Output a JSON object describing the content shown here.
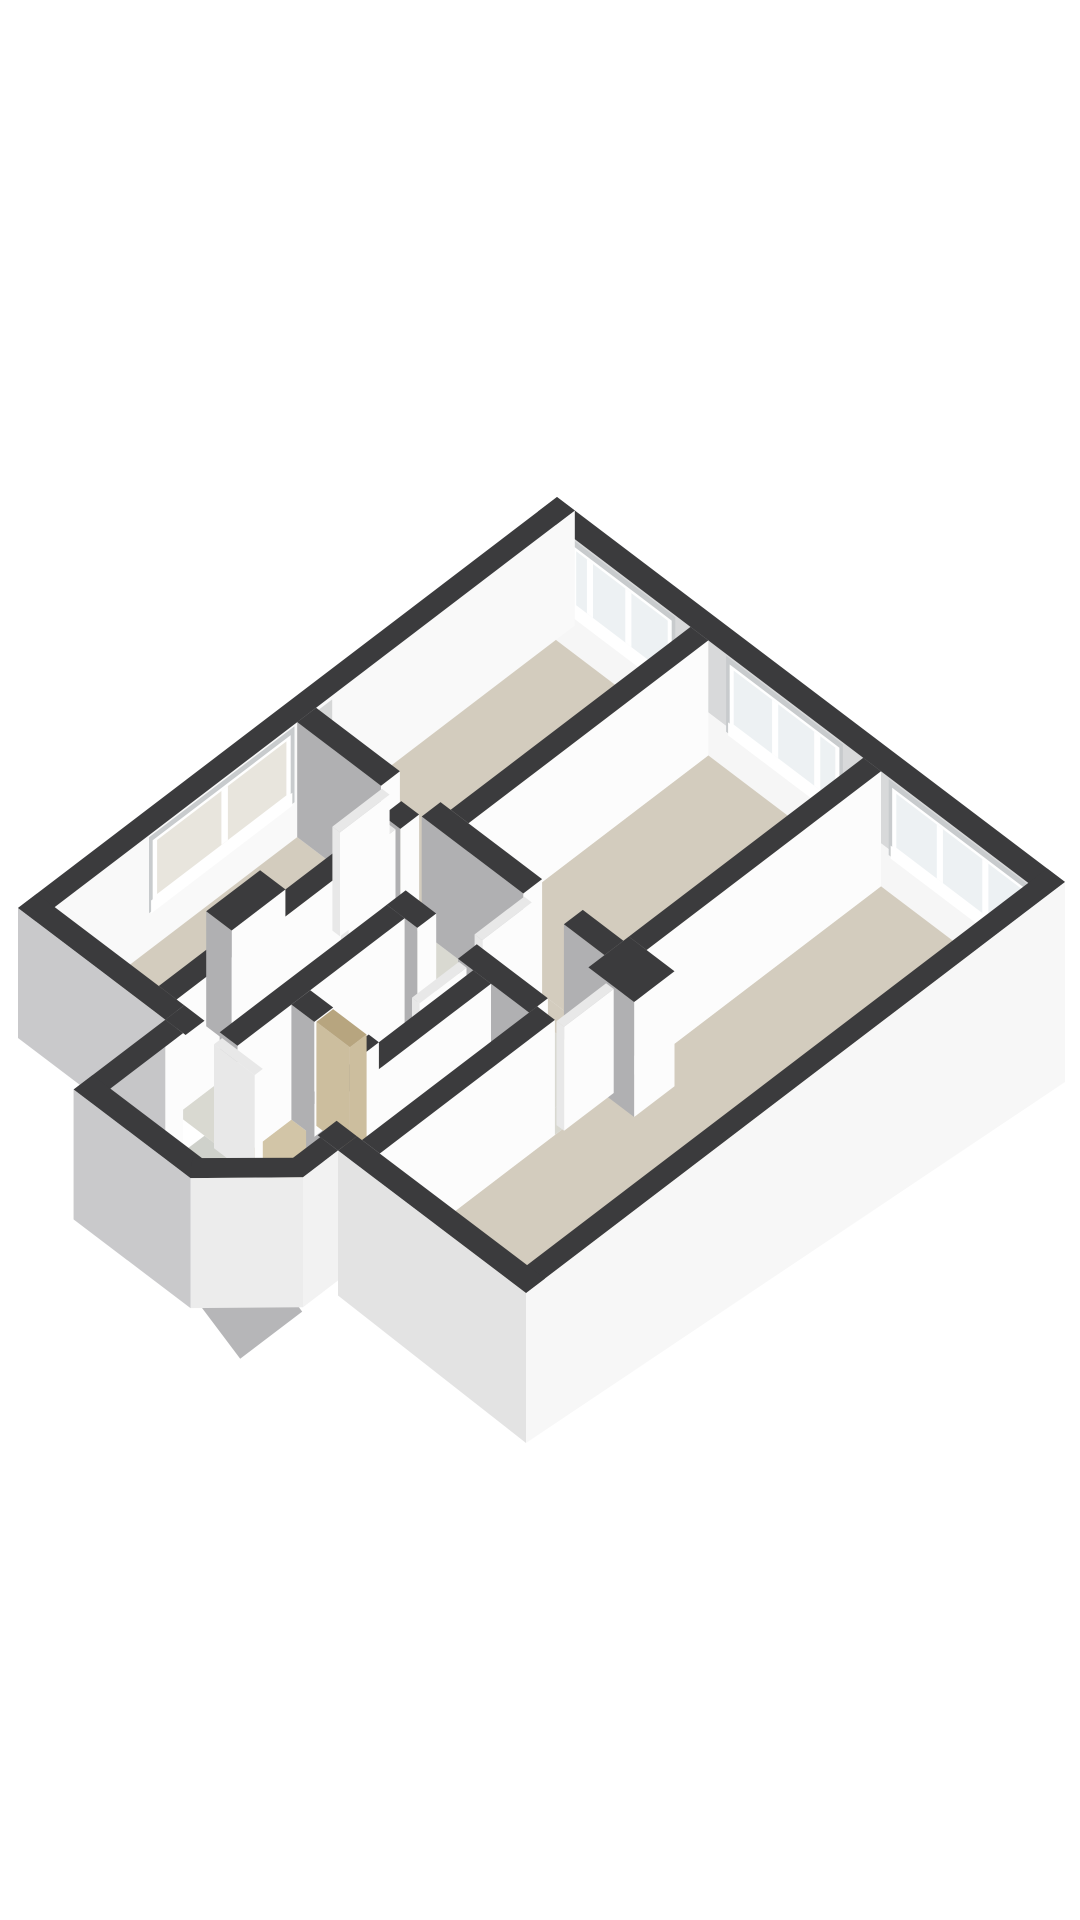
{
  "meta": {
    "description": "3D isometric floor plan render of an apartment, dark cut wall tops, white and grey wall faces, beige room floors, viewed from the south on a white background",
    "background": "#ffffff",
    "canvas": {
      "width": 1080,
      "height": 1920
    }
  },
  "projection": {
    "origin": [
      557,
      497
    ],
    "ux": [
      5.08,
      3.85
    ],
    "vy": [
      -5.39,
      4.11
    ],
    "wall_height": 115,
    "door_height": 104
  },
  "palette": {
    "wallTop": "#3b3b3d",
    "white": "#fcfcfc",
    "gray": "#b0b0b2",
    "grayLight": "#c6c6c8",
    "neUpper": "#d8d9da",
    "neLower": "#f6f6f6",
    "nwInner": "#f9f9f9",
    "recess": "#c8cbcd",
    "frame": "#ffffff",
    "glass": "#edf1f3",
    "frost": "#e8e5dd",
    "floorRoom": "#d3ccbe",
    "floorHall": "#d9d9d1",
    "floorBath": "#e0e2df",
    "floorWood": "#d2c5a7",
    "floorExt": "#cfd1cb",
    "stair": "#b6b6b8",
    "skirtSE": "#f7f7f7",
    "skirtSW": "#c9c9cb",
    "skirtSWLight": "#e3e3e3",
    "doorTop": "#e8e8e8",
    "doorWood": "#ccbe9e",
    "doorWoodTop": "#b7a57f",
    "nicheFill": "#d6d7d7",
    "diagFace": "#ececec",
    "extEFace": "#f2f2f2"
  },
  "elements": [
    {
      "t": "face",
      "n": "ne-wall-inner-upper",
      "plane": "y",
      "c": 3.5,
      "a": [
        0,
        100
      ],
      "top": [
        0,
        0
      ],
      "bot": [
        72,
        72
      ],
      "f": "neUpper"
    },
    {
      "t": "face",
      "n": "ne-wall-inner-lower",
      "plane": "y",
      "c": 3.5,
      "a": [
        0,
        100
      ],
      "top": [
        72,
        72
      ],
      "bot": [
        115,
        115
      ],
      "f": "neLower"
    },
    {
      "t": "window",
      "n": "window-bedroom-top",
      "plane": "y",
      "c": 3.5,
      "span": [
        6,
        27
      ],
      "mull": [
        0.2,
        0.56
      ],
      "f": "glass"
    },
    {
      "t": "window",
      "n": "window-bedroom-middle",
      "plane": "y",
      "c": 3.5,
      "span": [
        37,
        60
      ],
      "mull": [
        0.42,
        0.78
      ],
      "f": "glass"
    },
    {
      "t": "window",
      "n": "window-living-room",
      "plane": "y",
      "c": 3.5,
      "span": [
        69,
        97
      ],
      "mull": [
        0.36,
        0.68
      ],
      "f": "glass"
    },
    {
      "t": "top",
      "n": "ne-exterior-wall-top",
      "r": [
        0,
        0,
        100,
        3.5
      ]
    },
    {
      "t": "face",
      "n": "nw-wall-inner",
      "plane": "x",
      "c": 3.5,
      "a": [
        0,
        100
      ],
      "top": [
        0,
        0
      ],
      "bot": [
        115,
        115
      ],
      "f": "nwInner"
    },
    {
      "t": "face",
      "n": "nw-wall-niche",
      "plane": "x",
      "c": 3.5,
      "a": [
        45,
        50
      ],
      "top": [
        4,
        4
      ],
      "bot": [
        100,
        100
      ],
      "f": "nicheFill"
    },
    {
      "t": "window",
      "n": "window-left-room",
      "plane": "x",
      "c": 3.5,
      "span": [
        52,
        79
      ],
      "mull": [
        0.48
      ],
      "f": "frost"
    },
    {
      "t": "top",
      "n": "nw-exterior-wall-top",
      "r": [
        0,
        0,
        3.5,
        100
      ]
    },
    {
      "t": "floor",
      "n": "floor-bedroom-top",
      "r": [
        3.5,
        3.5,
        30,
        48
      ],
      "f": "floorRoom"
    },
    {
      "t": "floor",
      "n": "floor-bedroom-middle",
      "r": [
        33.5,
        3.5,
        64,
        48
      ],
      "f": "floorRoom"
    },
    {
      "t": "floor",
      "n": "floor-living-room",
      "r": [
        67.5,
        3.5,
        96.5,
        96.5
      ],
      "f": "floorRoom"
    },
    {
      "t": "floor",
      "n": "floor-left-bedroom",
      "r": [
        3.5,
        51.5,
        24,
        96.5
      ],
      "f": "floorRoom"
    },
    {
      "t": "floor",
      "n": "floor-hallway",
      "pts": [
        [
          27.5,
          51.5
        ],
        [
          64,
          51.5
        ],
        [
          64,
          62
        ],
        [
          36,
          62
        ],
        [
          36,
          96.5
        ],
        [
          27.5,
          96.5
        ]
      ],
      "f": "floorHall"
    },
    {
      "t": "floor",
      "n": "floor-bathroom",
      "r": [
        39.5,
        65.5,
        53,
        83
      ],
      "f": "floorBath"
    },
    {
      "t": "floor",
      "n": "floor-closet",
      "r": [
        39.5,
        86.5,
        53,
        96.5
      ],
      "f": "floorWood"
    },
    {
      "t": "floor",
      "n": "floor-toilet",
      "r": [
        56.5,
        65.5,
        64,
        96.5
      ],
      "f": "floorBath"
    },
    {
      "t": "floor",
      "n": "floor-stairwell",
      "r": [
        32.5,
        100,
        59.5,
        113.5
      ],
      "f": "floorExt"
    },
    {
      "t": "floor",
      "n": "threshold-bedroom-top",
      "r": [
        20,
        48,
        28,
        51.5
      ],
      "f": "floorRoom"
    },
    {
      "t": "floor",
      "n": "threshold-bedroom-middle",
      "r": [
        48,
        48,
        56,
        51.5
      ],
      "f": "floorRoom"
    },
    {
      "t": "floor",
      "n": "threshold-left-bedroom",
      "r": [
        24,
        55,
        27.5,
        64
      ],
      "f": "floorRoom"
    },
    {
      "t": "floor",
      "n": "threshold-living-room",
      "r": [
        64,
        54.5,
        67.5,
        64
      ],
      "f": "floorHall"
    },
    {
      "t": "floor",
      "n": "threshold-bathroom",
      "r": [
        42,
        62,
        50,
        65.5
      ],
      "f": "floorBath"
    },
    {
      "t": "floor",
      "n": "threshold-entry",
      "r": [
        33,
        96.5,
        59,
        100
      ],
      "f": "floorExt"
    },
    {
      "t": "wall",
      "n": "wall-bedrooms-divider",
      "r": [
        30,
        3.5,
        33.5,
        48
      ]
    },
    {
      "t": "wall",
      "n": "wall-hall-north-west",
      "r": [
        3.5,
        48,
        20,
        51.5
      ]
    },
    {
      "t": "wall",
      "n": "wall-hall-north-mid",
      "r": [
        28,
        48,
        48,
        51.5
      ]
    },
    {
      "t": "wall",
      "n": "wall-hall-north-east",
      "r": [
        56,
        48,
        64,
        51.5
      ]
    },
    {
      "t": "wall",
      "n": "wall-living-west-upper",
      "r": [
        64,
        3.5,
        67.5,
        47
      ]
    },
    {
      "t": "wall",
      "n": "duct-block",
      "r": [
        64,
        47,
        73,
        54.5
      ]
    },
    {
      "t": "door",
      "n": "door-living-room",
      "r": [
        67.8,
        54.8,
        69.3,
        64
      ]
    },
    {
      "t": "wall",
      "n": "wall-left-room-east-upper",
      "r": [
        24,
        51.5,
        27.5,
        55
      ]
    },
    {
      "t": "wall",
      "n": "wall-left-room-east-lower",
      "r": [
        24,
        64,
        27.5,
        96.5
      ]
    },
    {
      "t": "door",
      "n": "door-left-room",
      "r": [
        25.6,
        55.5,
        27.1,
        64.2
      ]
    },
    {
      "t": "wall",
      "n": "chimney-block",
      "r": [
        19,
        73,
        24,
        83
      ]
    },
    {
      "t": "door",
      "n": "door-bedroom-top",
      "r": [
        20.5,
        51.8,
        22,
        61
      ]
    },
    {
      "t": "door",
      "n": "door-bedroom-middle",
      "r": [
        48.5,
        51.8,
        50,
        61
      ]
    },
    {
      "t": "wall",
      "n": "wall-bathroom-north-west",
      "r": [
        36,
        62,
        42,
        65.5
      ]
    },
    {
      "t": "wall",
      "n": "wall-bathroom-north-east",
      "r": [
        50,
        62,
        64,
        65.5
      ]
    },
    {
      "t": "door",
      "n": "door-bathroom",
      "r": [
        50.5,
        65.8,
        52,
        74.5
      ]
    },
    {
      "t": "wall",
      "n": "wall-bathroom-west",
      "r": [
        36,
        65.5,
        39.5,
        96.5
      ]
    },
    {
      "t": "wall",
      "n": "wall-bathroom-toilet-divider",
      "r": [
        53,
        65.5,
        56.5,
        96.5
      ]
    },
    {
      "t": "wall",
      "n": "wall-closet-west",
      "r": [
        39.5,
        83,
        44,
        86.5
      ]
    },
    {
      "t": "wall",
      "n": "wall-closet-east",
      "r": [
        51,
        83,
        53,
        86.5
      ]
    },
    {
      "t": "door",
      "n": "door-closet-wood",
      "r": [
        44.2,
        83.2,
        50.8,
        86.3
      ],
      "fx": "doorWood",
      "fy": "doorWood",
      "ft": "doorWoodTop"
    },
    {
      "t": "wall",
      "n": "wall-living-west-lower",
      "r": [
        64,
        64,
        67.5,
        96.5
      ]
    },
    {
      "t": "top",
      "n": "se-exterior-wall-top",
      "r": [
        96.5,
        0,
        100,
        100
      ]
    },
    {
      "t": "face",
      "n": "se-exterior-skirt",
      "plane": "x",
      "c": 100,
      "a": [
        0,
        100
      ],
      "top": [
        0,
        0
      ],
      "bot": [
        200,
        150
      ],
      "f": "skirtSE"
    },
    {
      "t": "top",
      "n": "sw-exterior-wall-top-west",
      "r": [
        0,
        96.5,
        29,
        100
      ]
    },
    {
      "t": "face",
      "n": "sw-exterior-skirt-west",
      "plane": "y",
      "c": 100,
      "a": [
        0,
        29
      ],
      "top": [
        0,
        0
      ],
      "bot": [
        130,
        130
      ],
      "f": "skirtSW"
    },
    {
      "t": "top",
      "n": "sw-wall-stub-west",
      "r": [
        29,
        96.5,
        33,
        100
      ]
    },
    {
      "t": "top",
      "n": "sw-wall-stub-east",
      "r": [
        59,
        96.5,
        63,
        100
      ]
    },
    {
      "t": "top",
      "n": "sw-exterior-wall-top-east",
      "r": [
        63,
        96.5,
        100,
        100
      ]
    },
    {
      "t": "face",
      "n": "sw-exterior-skirt-east",
      "plane": "y",
      "c": 100,
      "a": [
        63,
        100
      ],
      "top": [
        0,
        0
      ],
      "bot": [
        145,
        150
      ],
      "f": "skirtSWLight"
    },
    {
      "t": "door",
      "n": "door-entry",
      "r": [
        37,
        97,
        45,
        98.5
      ]
    },
    {
      "t": "face",
      "n": "stairwell-wall-west-inner",
      "plane": "x",
      "c": 32.5,
      "a": [
        100,
        113.5
      ],
      "top": [
        0,
        0
      ],
      "bot": [
        115,
        115
      ],
      "f": "white"
    },
    {
      "t": "poly",
      "n": "stairwell-wall-west-outer",
      "pts3": [
        [
          29,
          100,
          0
        ],
        [
          29,
          117,
          0
        ],
        [
          29,
          117,
          130
        ],
        [
          29,
          100,
          130
        ]
      ],
      "f": "grayLight"
    },
    {
      "t": "top",
      "n": "stairwell-wall-west-top",
      "r": [
        29,
        100,
        32.5,
        117
      ]
    },
    {
      "t": "poly",
      "n": "staircase-slope",
      "pts3": [
        [
          35,
          101,
          116
        ],
        [
          57,
          101,
          180
        ],
        [
          57,
          112.5,
          180
        ],
        [
          35,
          112.5,
          116
        ]
      ],
      "f": "stair"
    },
    {
      "t": "top",
      "n": "stairwell-wall-south-top",
      "r": [
        29,
        113.5,
        52,
        117
      ]
    },
    {
      "t": "face",
      "n": "stairwell-wall-south-outer",
      "plane": "y",
      "c": 117,
      "a": [
        29,
        52
      ],
      "top": [
        0,
        0
      ],
      "bot": [
        130,
        130
      ],
      "f": "skirtSW"
    },
    {
      "t": "poly",
      "n": "stairwell-wall-diagonal-top",
      "pts3": [
        [
          49.6,
          114.4,
          0
        ],
        [
          60.6,
          104,
          0
        ],
        [
          63,
          106.5,
          0
        ],
        [
          52,
          117,
          0
        ]
      ],
      "f": "wallTop"
    },
    {
      "t": "poly",
      "n": "stairwell-wall-diagonal-outer",
      "pts3": [
        [
          52,
          117,
          0
        ],
        [
          63,
          106.5,
          0
        ],
        [
          63,
          106.5,
          130
        ],
        [
          52,
          117,
          130
        ]
      ],
      "f": "diagFace"
    },
    {
      "t": "top",
      "n": "stairwell-wall-east-top",
      "r": [
        59.5,
        100,
        63,
        106.5
      ]
    },
    {
      "t": "face",
      "n": "stairwell-wall-east-outer",
      "plane": "x",
      "c": 63,
      "a": [
        100,
        106.5
      ],
      "top": [
        0,
        0
      ],
      "bot": [
        130,
        130
      ],
      "f": "extEFace"
    }
  ]
}
